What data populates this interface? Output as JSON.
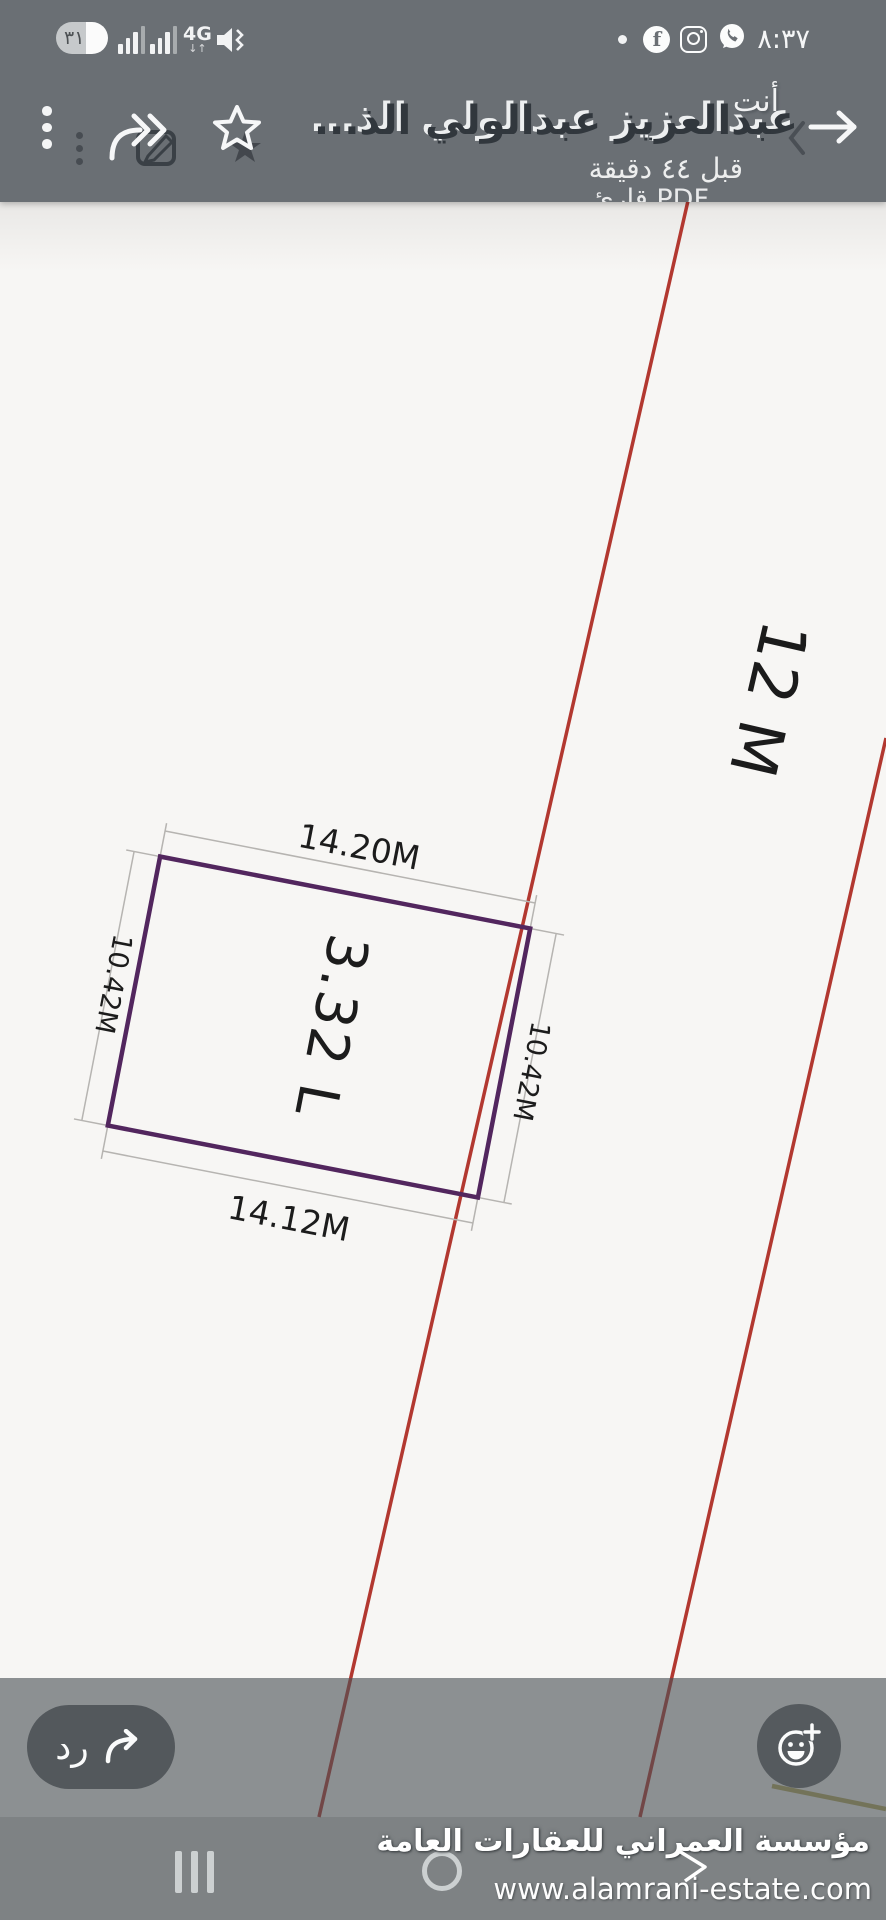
{
  "status_bar": {
    "battery_level": "٣١",
    "network_type": "4G",
    "time": "٨:٣٧"
  },
  "header": {
    "sender_label": "أنت",
    "contact_name": "عبدالعزيز عبدالولي الذ...",
    "timestamp": "قبل ٤٤ دقيقة",
    "document_label": "قارئ PDF"
  },
  "diagram": {
    "top_dimension": "14.20M",
    "bottom_dimension": "14.12M",
    "left_dimension": "10.42M",
    "right_dimension": "10.42M",
    "plot_area_label": "3.32 L",
    "road_width_label": "12 M",
    "colors": {
      "plot_border": "#52265e",
      "road_line": "#b23830",
      "dimension_line": "#b6b4b1",
      "label_text": "#1c1c1c",
      "boundary_yellow": "#b5aa60"
    }
  },
  "footer": {
    "reply_label": "رد"
  },
  "watermark": {
    "company": "مؤسسة العمراني للعقارات العامة",
    "website": "www.alamrani-estate.com"
  }
}
